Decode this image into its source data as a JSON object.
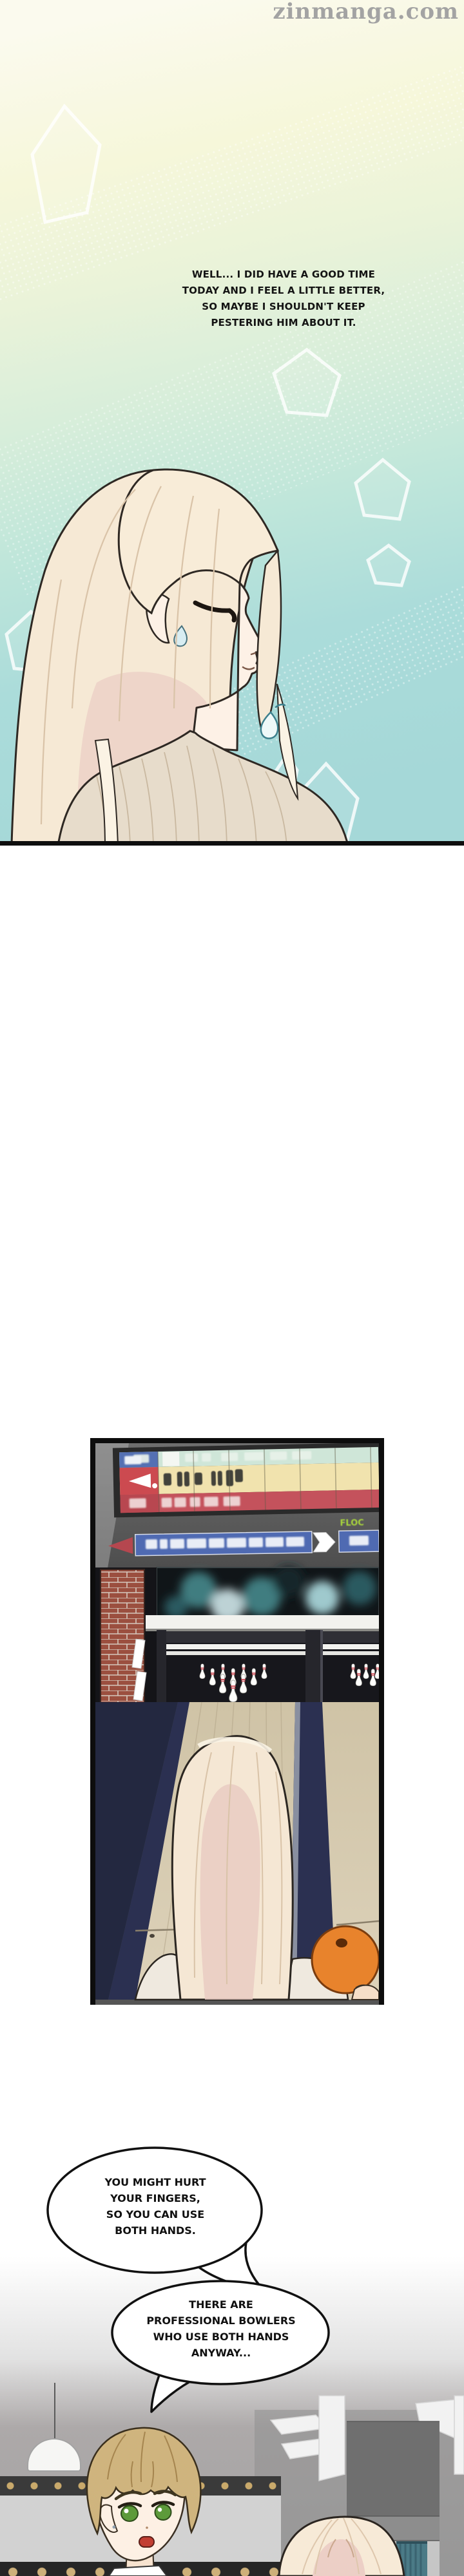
{
  "page": {
    "watermark": "zinmanga.com"
  },
  "panel1": {
    "monologue_lines": [
      "WELL... I DID HAVE A GOOD TIME",
      "TODAY AND I FEEL A LITTLE BETTER,",
      "SO MAYBE I SHOULDN'T KEEP",
      "PESTERING HIM ABOUT IT."
    ]
  },
  "bowling": {
    "screen_label": "FLOC"
  },
  "bubbles": {
    "bubble1_lines": [
      "YOU MIGHT HURT",
      "YOUR FINGERS,",
      "SO YOU CAN USE",
      "BOTH HANDS."
    ],
    "bubble2_lines": [
      "THERE ARE",
      "PROFESSIONAL BOWLERS",
      "WHO USE BOTH HANDS",
      "ANYWAY..."
    ]
  },
  "colors": {
    "panel1_teal": "#a5d8d8",
    "panel1_cream": "#fbfaee",
    "scoreboard_teal_row": "#cfe6d8",
    "scoreboard_yellow_row": "#f1e3ae",
    "scoreboard_red_row": "#c4525c",
    "banner_blue": "#4f6ab2",
    "ball_orange": "#e8832c",
    "lane_wood": "#d3c7ab",
    "gutter_navy": "#2b3051",
    "gold_dot": "#c9a96b",
    "curtain_teal": "#4b7a86"
  }
}
